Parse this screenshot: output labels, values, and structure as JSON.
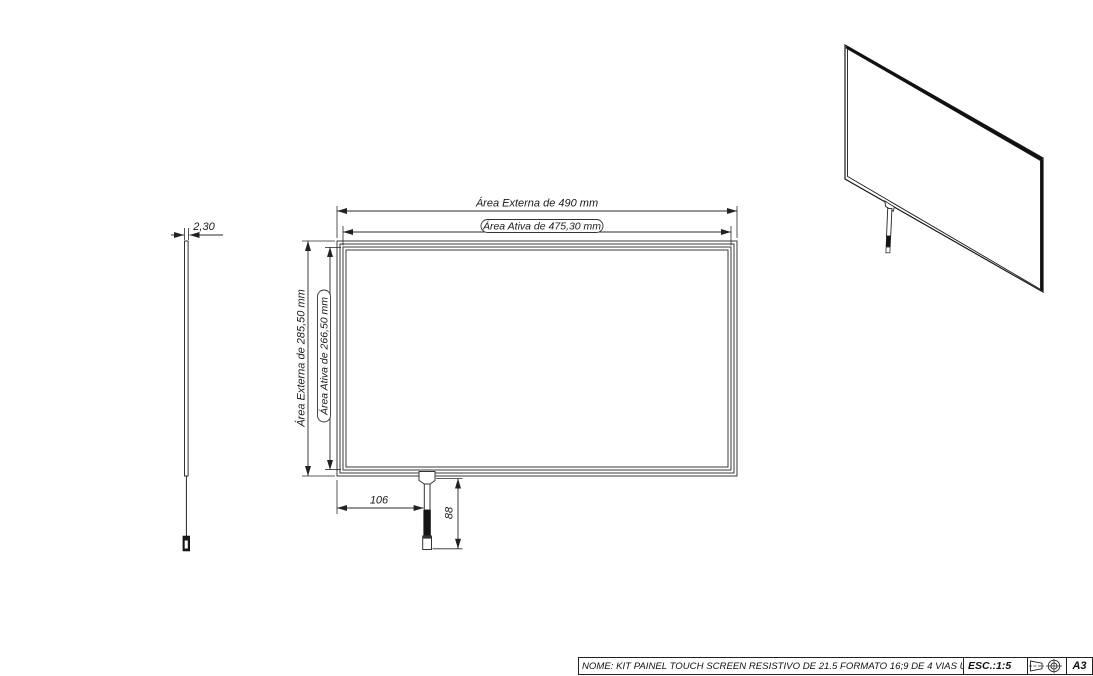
{
  "drawing": {
    "side_view": {
      "thickness": "2,30"
    },
    "front_view": {
      "width_external": "Área Externa de 490 mm",
      "width_active": "Área Ativa de 475,30 mm",
      "height_external": "Área Externa de 285,50 mm",
      "height_active": "Área Ativa de 266,50 mm",
      "tail_offset": "106",
      "tail_length": "88"
    },
    "title_block": {
      "name": "NOME: KIT PAINEL TOUCH SCREEN RESISTIVO DE 21.5 FORMATO 16;9 DE 4 VIAS USB",
      "scale": "ESC.:1:5",
      "sheet": "A3",
      "icons": [
        "projection-frustum-side-icon",
        "projection-frustum-front-icon"
      ]
    },
    "colors": {
      "line": "#222222",
      "background": "#ffffff"
    }
  }
}
